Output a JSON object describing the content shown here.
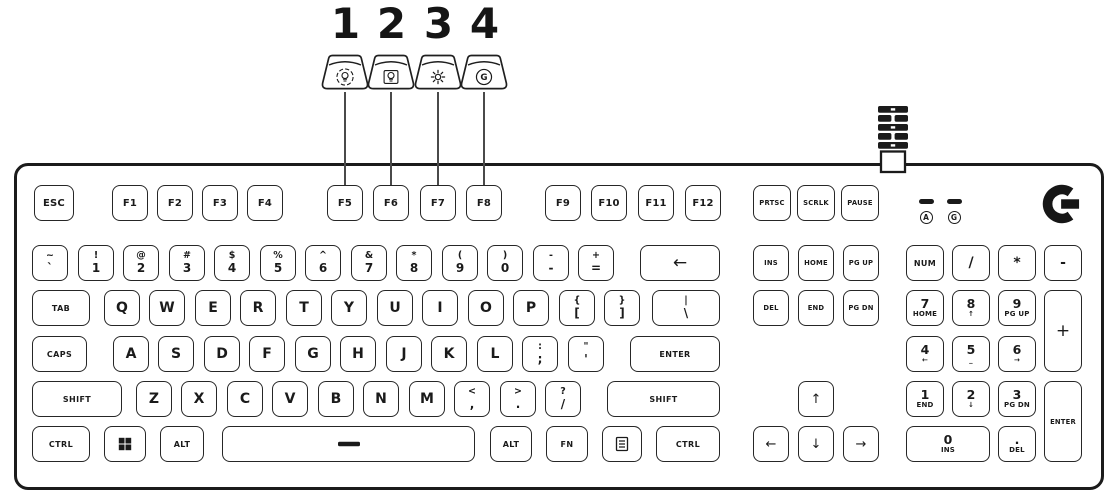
{
  "colors": {
    "ink": "#1a1a1a",
    "background": "#ffffff"
  },
  "callouts": [
    {
      "number": "1",
      "icon": "lightbulb-cycle-icon",
      "cx": 345
    },
    {
      "number": "2",
      "icon": "lightbulb-frame-icon",
      "cx": 391
    },
    {
      "number": "3",
      "icon": "brightness-icon",
      "cx": 438
    },
    {
      "number": "4",
      "icon": "game-mode-g-icon",
      "cx": 484
    }
  ],
  "keyboard": {
    "logo_icon": "logitech-g-logo",
    "cable_icon": "braided-cable-icon",
    "indicators": [
      {
        "name": "caps-lock-indicator",
        "letter": "A"
      },
      {
        "name": "game-mode-indicator",
        "letter": "G"
      }
    ],
    "keys": [
      {
        "id": "esc",
        "label": "ESC",
        "x": 34,
        "y": 185,
        "w": 40,
        "cls": "md"
      },
      {
        "id": "f1",
        "label": "F1",
        "x": 112,
        "y": 185,
        "cls": "md"
      },
      {
        "id": "f2",
        "label": "F2",
        "x": 157,
        "y": 185,
        "cls": "md"
      },
      {
        "id": "f3",
        "label": "F3",
        "x": 202,
        "y": 185,
        "cls": "md"
      },
      {
        "id": "f4",
        "label": "F4",
        "x": 247,
        "y": 185,
        "cls": "md"
      },
      {
        "id": "f5",
        "label": "F5",
        "x": 327,
        "y": 185,
        "cls": "md"
      },
      {
        "id": "f6",
        "label": "F6",
        "x": 373,
        "y": 185,
        "cls": "md"
      },
      {
        "id": "f7",
        "label": "F7",
        "x": 420,
        "y": 185,
        "cls": "md"
      },
      {
        "id": "f8",
        "label": "F8",
        "x": 466,
        "y": 185,
        "cls": "md"
      },
      {
        "id": "f9",
        "label": "F9",
        "x": 545,
        "y": 185,
        "cls": "md"
      },
      {
        "id": "f10",
        "label": "F10",
        "x": 591,
        "y": 185,
        "cls": "md"
      },
      {
        "id": "f11",
        "label": "F11",
        "x": 638,
        "y": 185,
        "cls": "md"
      },
      {
        "id": "f12",
        "label": "F12",
        "x": 685,
        "y": 185,
        "cls": "md"
      },
      {
        "id": "prtsc",
        "label": "PRTSC",
        "x": 753,
        "y": 185,
        "w": 38,
        "cls": "xs"
      },
      {
        "id": "scrlk",
        "label": "SCRLK",
        "x": 797,
        "y": 185,
        "w": 38,
        "cls": "xs"
      },
      {
        "id": "pause",
        "label": "PAUSE",
        "x": 841,
        "y": 185,
        "w": 38,
        "cls": "xs"
      },
      {
        "id": "grave",
        "top": "~",
        "bottom": "`",
        "x": 32,
        "y": 245,
        "cls": "dual"
      },
      {
        "id": "num1",
        "top": "!",
        "bottom": "1",
        "x": 78,
        "y": 245,
        "cls": "dual"
      },
      {
        "id": "num2",
        "top": "@",
        "bottom": "2",
        "x": 123,
        "y": 245,
        "cls": "dual"
      },
      {
        "id": "num3",
        "top": "#",
        "bottom": "3",
        "x": 169,
        "y": 245,
        "cls": "dual"
      },
      {
        "id": "num4",
        "top": "$",
        "bottom": "4",
        "x": 214,
        "y": 245,
        "cls": "dual"
      },
      {
        "id": "num5",
        "top": "%",
        "bottom": "5",
        "x": 260,
        "y": 245,
        "cls": "dual"
      },
      {
        "id": "num6",
        "top": "^",
        "bottom": "6",
        "x": 305,
        "y": 245,
        "cls": "dual"
      },
      {
        "id": "num7",
        "top": "&",
        "bottom": "7",
        "x": 351,
        "y": 245,
        "cls": "dual"
      },
      {
        "id": "num8",
        "top": "*",
        "bottom": "8",
        "x": 396,
        "y": 245,
        "cls": "dual"
      },
      {
        "id": "num9",
        "top": "(",
        "bottom": "9",
        "x": 442,
        "y": 245,
        "cls": "dual"
      },
      {
        "id": "num0",
        "top": ")",
        "bottom": "0",
        "x": 487,
        "y": 245,
        "cls": "dual"
      },
      {
        "id": "minus",
        "top": "-",
        "bottom": "-",
        "x": 533,
        "y": 245,
        "cls": "dual"
      },
      {
        "id": "equals",
        "top": "+",
        "bottom": "=",
        "x": 578,
        "y": 245,
        "cls": "dual"
      },
      {
        "id": "backspace",
        "label": "←",
        "x": 640,
        "y": 245,
        "w": 80,
        "cls": "sym"
      },
      {
        "id": "tab",
        "label": "TAB",
        "x": 32,
        "y": 290,
        "w": 58,
        "cls": "sm"
      },
      {
        "id": "q",
        "label": "Q",
        "x": 104,
        "y": 290,
        "cls": "letter"
      },
      {
        "id": "w",
        "label": "W",
        "x": 149,
        "y": 290,
        "cls": "letter"
      },
      {
        "id": "e",
        "label": "E",
        "x": 195,
        "y": 290,
        "cls": "letter"
      },
      {
        "id": "r",
        "label": "R",
        "x": 240,
        "y": 290,
        "cls": "letter"
      },
      {
        "id": "t",
        "label": "T",
        "x": 286,
        "y": 290,
        "cls": "letter"
      },
      {
        "id": "y",
        "label": "Y",
        "x": 331,
        "y": 290,
        "cls": "letter"
      },
      {
        "id": "u",
        "label": "U",
        "x": 377,
        "y": 290,
        "cls": "letter"
      },
      {
        "id": "i",
        "label": "I",
        "x": 422,
        "y": 290,
        "cls": "letter"
      },
      {
        "id": "o",
        "label": "O",
        "x": 468,
        "y": 290,
        "cls": "letter"
      },
      {
        "id": "p",
        "label": "P",
        "x": 513,
        "y": 290,
        "cls": "letter"
      },
      {
        "id": "lbracket",
        "top": "{",
        "bottom": "[",
        "x": 559,
        "y": 290,
        "cls": "dual"
      },
      {
        "id": "rbracket",
        "top": "}",
        "bottom": "]",
        "x": 604,
        "y": 290,
        "cls": "dual"
      },
      {
        "id": "backslash",
        "top": "|",
        "bottom": "\\",
        "x": 652,
        "y": 290,
        "w": 68,
        "cls": "dual"
      },
      {
        "id": "caps",
        "label": "CAPS",
        "x": 32,
        "y": 336,
        "w": 55,
        "cls": "sm"
      },
      {
        "id": "a",
        "label": "A",
        "x": 113,
        "y": 336,
        "cls": "letter"
      },
      {
        "id": "s",
        "label": "S",
        "x": 158,
        "y": 336,
        "cls": "letter"
      },
      {
        "id": "d",
        "label": "D",
        "x": 204,
        "y": 336,
        "cls": "letter"
      },
      {
        "id": "f",
        "label": "F",
        "x": 249,
        "y": 336,
        "cls": "letter"
      },
      {
        "id": "g",
        "label": "G",
        "x": 295,
        "y": 336,
        "cls": "letter"
      },
      {
        "id": "h",
        "label": "H",
        "x": 340,
        "y": 336,
        "cls": "letter"
      },
      {
        "id": "j",
        "label": "J",
        "x": 386,
        "y": 336,
        "cls": "letter"
      },
      {
        "id": "k",
        "label": "K",
        "x": 431,
        "y": 336,
        "cls": "letter"
      },
      {
        "id": "l",
        "label": "L",
        "x": 477,
        "y": 336,
        "cls": "letter"
      },
      {
        "id": "semicolon",
        "top": ":",
        "bottom": ";",
        "x": 522,
        "y": 336,
        "cls": "dual"
      },
      {
        "id": "quote",
        "top": "\"",
        "bottom": "'",
        "x": 568,
        "y": 336,
        "cls": "dual"
      },
      {
        "id": "enter",
        "label": "ENTER",
        "x": 630,
        "y": 336,
        "w": 90,
        "cls": "sm"
      },
      {
        "id": "lshift",
        "label": "SHIFT",
        "x": 32,
        "y": 381,
        "w": 90,
        "cls": "sm"
      },
      {
        "id": "z",
        "label": "Z",
        "x": 136,
        "y": 381,
        "cls": "letter"
      },
      {
        "id": "x",
        "label": "X",
        "x": 181,
        "y": 381,
        "cls": "letter"
      },
      {
        "id": "c",
        "label": "C",
        "x": 227,
        "y": 381,
        "cls": "letter"
      },
      {
        "id": "v",
        "label": "V",
        "x": 272,
        "y": 381,
        "cls": "letter"
      },
      {
        "id": "b",
        "label": "B",
        "x": 318,
        "y": 381,
        "cls": "letter"
      },
      {
        "id": "n",
        "label": "N",
        "x": 363,
        "y": 381,
        "cls": "letter"
      },
      {
        "id": "m",
        "label": "M",
        "x": 409,
        "y": 381,
        "cls": "letter"
      },
      {
        "id": "comma",
        "top": "<",
        "bottom": ",",
        "x": 454,
        "y": 381,
        "cls": "dual"
      },
      {
        "id": "period",
        "top": ">",
        "bottom": ".",
        "x": 500,
        "y": 381,
        "cls": "dual"
      },
      {
        "id": "slash",
        "top": "?",
        "bottom": "/",
        "x": 545,
        "y": 381,
        "cls": "dual"
      },
      {
        "id": "rshift",
        "label": "SHIFT",
        "x": 607,
        "y": 381,
        "w": 113,
        "cls": "sm"
      },
      {
        "id": "lctrl",
        "label": "CTRL",
        "x": 32,
        "y": 426,
        "w": 58,
        "cls": "sm"
      },
      {
        "id": "win",
        "icon": "windows-icon",
        "x": 104,
        "y": 426,
        "w": 42
      },
      {
        "id": "lalt",
        "label": "ALT",
        "x": 160,
        "y": 426,
        "w": 44,
        "cls": "sm"
      },
      {
        "id": "space",
        "icon": "space-dash-icon",
        "x": 222,
        "y": 426,
        "w": 253
      },
      {
        "id": "ralt",
        "label": "ALT",
        "x": 490,
        "y": 426,
        "w": 42,
        "cls": "sm"
      },
      {
        "id": "fn",
        "label": "FN",
        "x": 546,
        "y": 426,
        "w": 42,
        "cls": "sm"
      },
      {
        "id": "menu",
        "icon": "menu-icon",
        "x": 602,
        "y": 426,
        "w": 40
      },
      {
        "id": "rctrl",
        "label": "CTRL",
        "x": 656,
        "y": 426,
        "w": 64,
        "cls": "sm"
      },
      {
        "id": "ins",
        "label": "INS",
        "x": 753,
        "y": 245,
        "w": 36,
        "cls": "xs"
      },
      {
        "id": "home",
        "label": "HOME",
        "x": 798,
        "y": 245,
        "w": 36,
        "cls": "xs"
      },
      {
        "id": "pgup",
        "label": "PG UP",
        "x": 843,
        "y": 245,
        "w": 36,
        "cls": "xs"
      },
      {
        "id": "del",
        "label": "DEL",
        "x": 753,
        "y": 290,
        "w": 36,
        "cls": "xs"
      },
      {
        "id": "end",
        "label": "END",
        "x": 798,
        "y": 290,
        "w": 36,
        "cls": "xs"
      },
      {
        "id": "pgdn",
        "label": "PG DN",
        "x": 843,
        "y": 290,
        "w": 36,
        "cls": "xs"
      },
      {
        "id": "up",
        "label": "↑",
        "x": 798,
        "y": 381,
        "w": 36,
        "cls": "arrow"
      },
      {
        "id": "left",
        "label": "←",
        "x": 753,
        "y": 426,
        "w": 36,
        "cls": "arrow"
      },
      {
        "id": "down",
        "label": "↓",
        "x": 798,
        "y": 426,
        "w": 36,
        "cls": "arrow"
      },
      {
        "id": "right",
        "label": "→",
        "x": 843,
        "y": 426,
        "w": 36,
        "cls": "arrow"
      },
      {
        "id": "num",
        "label": "NUM",
        "x": 906,
        "y": 245,
        "w": 38,
        "cls": "sm"
      },
      {
        "id": "npdivide",
        "label": "/",
        "x": 952,
        "y": 245,
        "w": 38,
        "cls": "letter"
      },
      {
        "id": "npmultiply",
        "label": "*",
        "x": 998,
        "y": 245,
        "w": 38,
        "cls": "letter"
      },
      {
        "id": "npminus",
        "label": "-",
        "x": 1044,
        "y": 245,
        "w": 38,
        "cls": "letter"
      },
      {
        "id": "np7",
        "top": "7",
        "bottom": "HOME",
        "x": 906,
        "y": 290,
        "w": 38,
        "cls": "npdual"
      },
      {
        "id": "np8",
        "top": "8",
        "bottom": "↑",
        "x": 952,
        "y": 290,
        "w": 38,
        "cls": "npdual"
      },
      {
        "id": "np9",
        "top": "9",
        "bottom": "PG UP",
        "x": 998,
        "y": 290,
        "w": 38,
        "cls": "npdual"
      },
      {
        "id": "npplus",
        "label": "+",
        "x": 1044,
        "y": 290,
        "w": 38,
        "h": 82,
        "cls": "sym"
      },
      {
        "id": "np4",
        "top": "4",
        "bottom": "←",
        "x": 906,
        "y": 336,
        "w": 38,
        "cls": "npdual"
      },
      {
        "id": "np5",
        "top": "5",
        "bottom": "_",
        "x": 952,
        "y": 336,
        "w": 38,
        "cls": "npdual"
      },
      {
        "id": "np6",
        "top": "6",
        "bottom": "→",
        "x": 998,
        "y": 336,
        "w": 38,
        "cls": "npdual"
      },
      {
        "id": "np1",
        "top": "1",
        "bottom": "END",
        "x": 906,
        "y": 381,
        "w": 38,
        "cls": "npdual"
      },
      {
        "id": "np2",
        "top": "2",
        "bottom": "↓",
        "x": 952,
        "y": 381,
        "w": 38,
        "cls": "npdual"
      },
      {
        "id": "np3",
        "top": "3",
        "bottom": "PG DN",
        "x": 998,
        "y": 381,
        "w": 38,
        "cls": "npdual"
      },
      {
        "id": "npenter",
        "label": "ENTER",
        "x": 1044,
        "y": 381,
        "w": 38,
        "h": 81,
        "cls": "xs"
      },
      {
        "id": "np0",
        "top": "0",
        "bottom": "INS",
        "x": 906,
        "y": 426,
        "w": 84,
        "cls": "npdual"
      },
      {
        "id": "npdecimal",
        "top": ".",
        "bottom": "DEL",
        "x": 998,
        "y": 426,
        "w": 38,
        "cls": "npdual"
      }
    ]
  }
}
